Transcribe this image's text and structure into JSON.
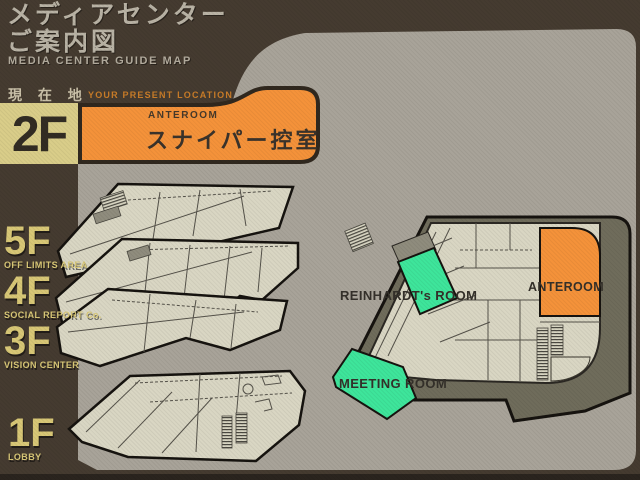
{
  "header": {
    "title_line1": "メディアセンター",
    "title_line2": "ご案内図",
    "subtitle": "MEDIA CENTER GUIDE MAP"
  },
  "location": {
    "label_ja": "現 在 地",
    "label_en": "YOUR PRESENT LOCATION",
    "floor": "2F",
    "room_en": "ANTEROOM",
    "room_ja": "スナイパー控室"
  },
  "floor_list": [
    {
      "label": "5F",
      "name": "OFF LIMITS AREA"
    },
    {
      "label": "4F",
      "name": "SOCIAL REPORT Co."
    },
    {
      "label": "3F",
      "name": "VISION CENTER"
    },
    {
      "label": "1F",
      "name": "LOBBY"
    }
  ],
  "map": {
    "floor": "2F",
    "rooms": {
      "reinhardt": "REINHARDT's ROOM",
      "anteroom": "ANTEROOM",
      "meeting": "MEETING ROOM"
    }
  },
  "colors": {
    "background": "#453b30",
    "panel_gray": "#a8a399",
    "accent_orange": "#f4923a",
    "accent_green": "#3ee59b",
    "khaki": "#d9cd89",
    "floor_plan": "#d9d6c3",
    "base_plate": "#6f6c5b"
  }
}
